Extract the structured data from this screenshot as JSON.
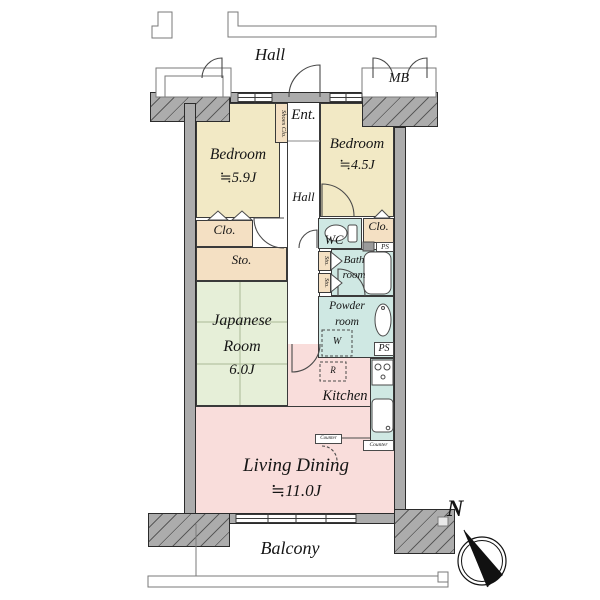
{
  "plan": {
    "outside": {
      "hall": "Hall",
      "mb": "MB",
      "balcony": "Balcony"
    },
    "compass": {
      "north": "N"
    },
    "rooms": {
      "entrance": "Ent.",
      "shoes_closet": "Shoes Clo.",
      "bedroom1": {
        "name": "Bedroom",
        "size": "≒5.9J"
      },
      "bedroom2": {
        "name": "Bedroom",
        "size": "≒4.5J"
      },
      "hall": "Hall",
      "closet_left": "Clo.",
      "storage_left": "Sto.",
      "wc": "WC",
      "closet_right": "Clo.",
      "pipe_space_upper": "PS",
      "storage_small_upper": "Sto.",
      "storage_small_lower": "Sto.",
      "bathroom": "Bath room",
      "powder_room": "Powder room",
      "washer": "W",
      "pipe_space_lower": "PS",
      "refrigerator": "R",
      "kitchen": "Kitchen",
      "counter_left": "Counter",
      "counter_right": "Counter",
      "japanese_room": {
        "name": "Japanese Room",
        "size": "6.0J"
      },
      "living_dining": {
        "name": "Living Dining",
        "size": "≒11.0J"
      }
    },
    "colors": {
      "wall": "#ACACAC",
      "bedroom": "#F2E9C5",
      "closet": "#F4E0C3",
      "tatami_room": "#E6EFD8",
      "living": "#F9DDDB",
      "wet_area": "#CFE8E3",
      "outline": "#3A3A3A"
    }
  }
}
